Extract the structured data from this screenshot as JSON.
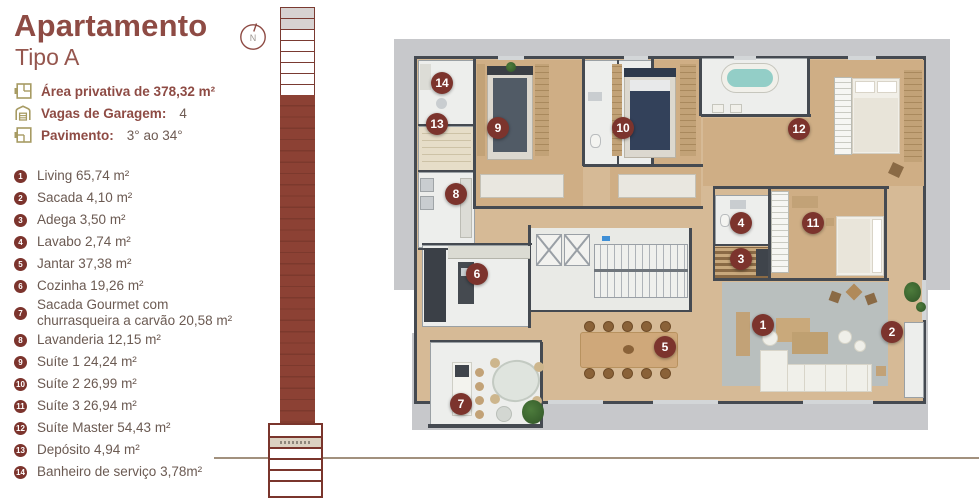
{
  "header": {
    "title": "Apartamento",
    "subtitle": "Tipo A"
  },
  "info": [
    {
      "icon": "floorplan-icon",
      "label": "Área privativa de 378,32 m²",
      "value": ""
    },
    {
      "icon": "garage-icon",
      "label": "Vagas de Garagem:",
      "value": "4"
    },
    {
      "icon": "floors-icon",
      "label": "Pavimento:",
      "value": "3° ao 34°"
    }
  ],
  "legend": [
    {
      "n": "1",
      "text": "Living 65,74 m²"
    },
    {
      "n": "2",
      "text": "Sacada 4,10 m²"
    },
    {
      "n": "3",
      "text": "Adega 3,50 m²"
    },
    {
      "n": "4",
      "text": "Lavabo 2,74 m²"
    },
    {
      "n": "5",
      "text": "Jantar 37,38 m²"
    },
    {
      "n": "6",
      "text": "Cozinha 19,26 m²"
    },
    {
      "n": "7",
      "text": "Sacada Gourmet com churrasqueira a carvão 20,58 m²"
    },
    {
      "n": "8",
      "text": "Lavanderia 12,15 m²"
    },
    {
      "n": "9",
      "text": "Suíte 1 24,24 m²"
    },
    {
      "n": "10",
      "text": "Suíte 2 26,99 m²"
    },
    {
      "n": "11",
      "text": "Suíte 3 26,94 m²"
    },
    {
      "n": "12",
      "text": "Suíte Master 54,43 m²"
    },
    {
      "n": "13",
      "text": "Depósito 4,94 m²"
    },
    {
      "n": "14",
      "text": "Banheiro de serviço 3,78m²"
    }
  ],
  "compass": {
    "letter": "N"
  },
  "elevation": {
    "outlined_floors": 8,
    "shaded_floors": 2
  },
  "plan": {
    "markers": [
      {
        "n": "1",
        "x": 385,
        "y": 295
      },
      {
        "n": "2",
        "x": 514,
        "y": 302
      },
      {
        "n": "3",
        "x": 363,
        "y": 229
      },
      {
        "n": "4",
        "x": 363,
        "y": 193
      },
      {
        "n": "5",
        "x": 287,
        "y": 317
      },
      {
        "n": "6",
        "x": 99,
        "y": 244
      },
      {
        "n": "7",
        "x": 83,
        "y": 374
      },
      {
        "n": "8",
        "x": 78,
        "y": 164
      },
      {
        "n": "9",
        "x": 120,
        "y": 98
      },
      {
        "n": "10",
        "x": 245,
        "y": 98
      },
      {
        "n": "11",
        "x": 435,
        "y": 193
      },
      {
        "n": "12",
        "x": 421,
        "y": 99
      },
      {
        "n": "13",
        "x": 59,
        "y": 94
      },
      {
        "n": "14",
        "x": 64,
        "y": 53
      }
    ]
  },
  "colors": {
    "accent_red": "#8e4b44",
    "marker_red": "#7c342d",
    "icon_olive": "#a79b63",
    "text_brown": "#6b5a52",
    "tower_brown": "#8c4134",
    "slab_gray": "#c7c8cb",
    "wood_floor": "#cfae85"
  }
}
